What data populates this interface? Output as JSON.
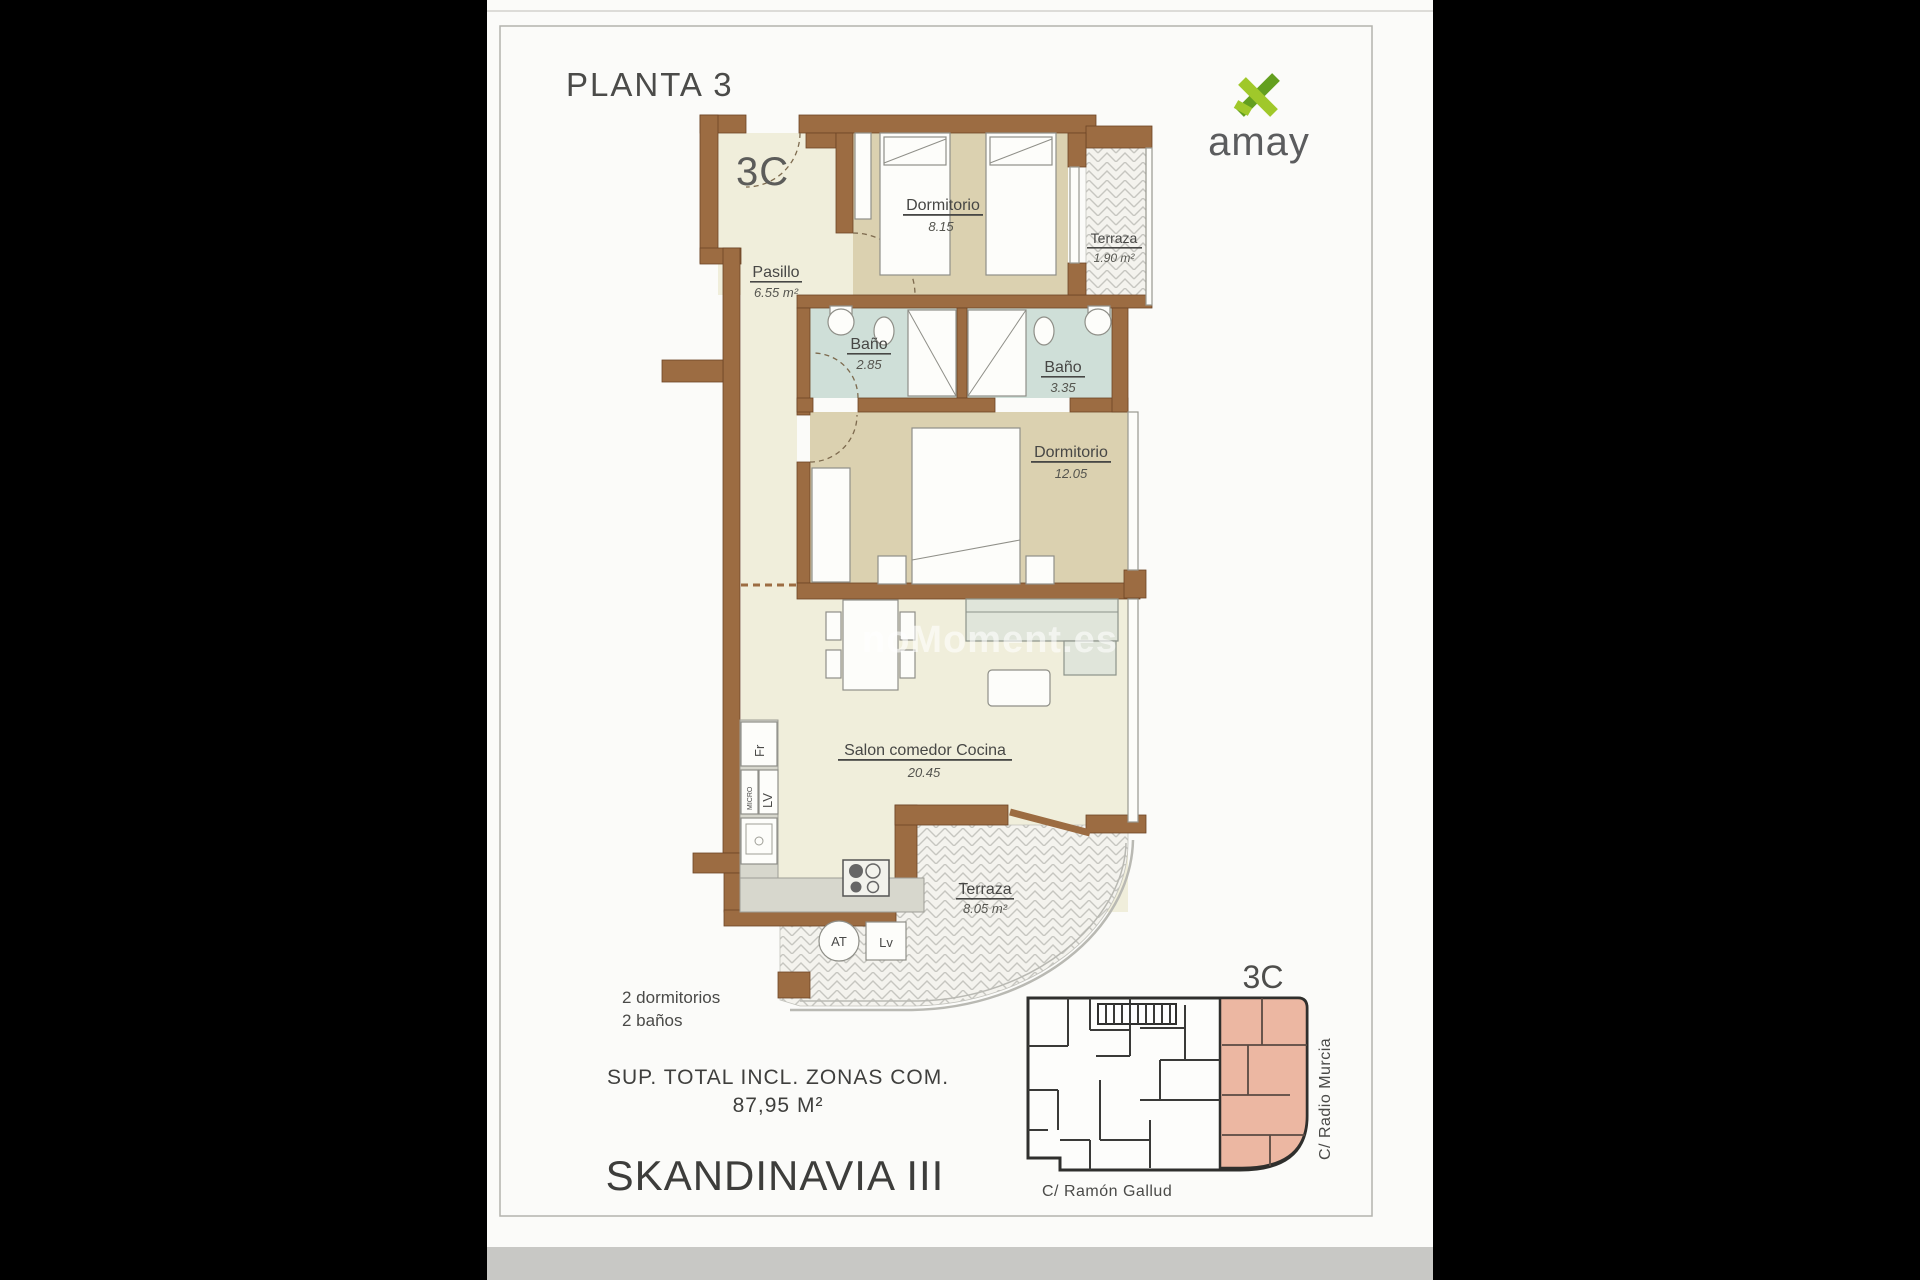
{
  "header": {
    "title": "PLANTA 3",
    "unit": "3C"
  },
  "logo": {
    "text": "amay"
  },
  "plan": {
    "unit_label": "3C",
    "rooms": [
      {
        "id": "dormitorio1",
        "name": "Dormitorio",
        "area": "8.15"
      },
      {
        "id": "terraza1",
        "name": "Terraza",
        "area": "1.90 m²"
      },
      {
        "id": "pasillo",
        "name": "Pasillo",
        "area": "6.55 m²"
      },
      {
        "id": "bano1",
        "name": "Baño",
        "area": "2.85"
      },
      {
        "id": "bano2",
        "name": "Baño",
        "area": "3.35"
      },
      {
        "id": "dormitorio2",
        "name": "Dormitorio",
        "area": "12.05"
      },
      {
        "id": "salon",
        "name": "Salon comedor Cocina",
        "area": "20.45"
      },
      {
        "id": "terraza2",
        "name": "Terraza",
        "area": "8.05 m²"
      }
    ],
    "appliances": {
      "fridge": "Fr",
      "microwave": "MICRO",
      "dishwasher": "LV",
      "water_heater": "AT",
      "washer": "Lv"
    }
  },
  "watermark": "noMoment.es",
  "summary": {
    "bedrooms": "2 dormitorios",
    "bathrooms": "2 baños",
    "total_label": "SUP. TOTAL INCL. ZONAS COM.",
    "total_value": "87,95 M²",
    "project": "SKANDINAVIA III"
  },
  "keyplan": {
    "unit": "3C",
    "street_bottom": "C/ Ramón Gallud",
    "street_right": "C/ Radio Murcia"
  },
  "colors": {
    "wall_brown": "#9c6c42",
    "floor_pale": "#f0eedb",
    "floor_bedroom": "#dbd1b0",
    "floor_bath": "#cfdfd8",
    "keyplan_highlight": "#ecb7a2",
    "logo_green_light": "#a0c82a",
    "logo_green_dark": "#639f1f",
    "text_gray": "#474745"
  }
}
